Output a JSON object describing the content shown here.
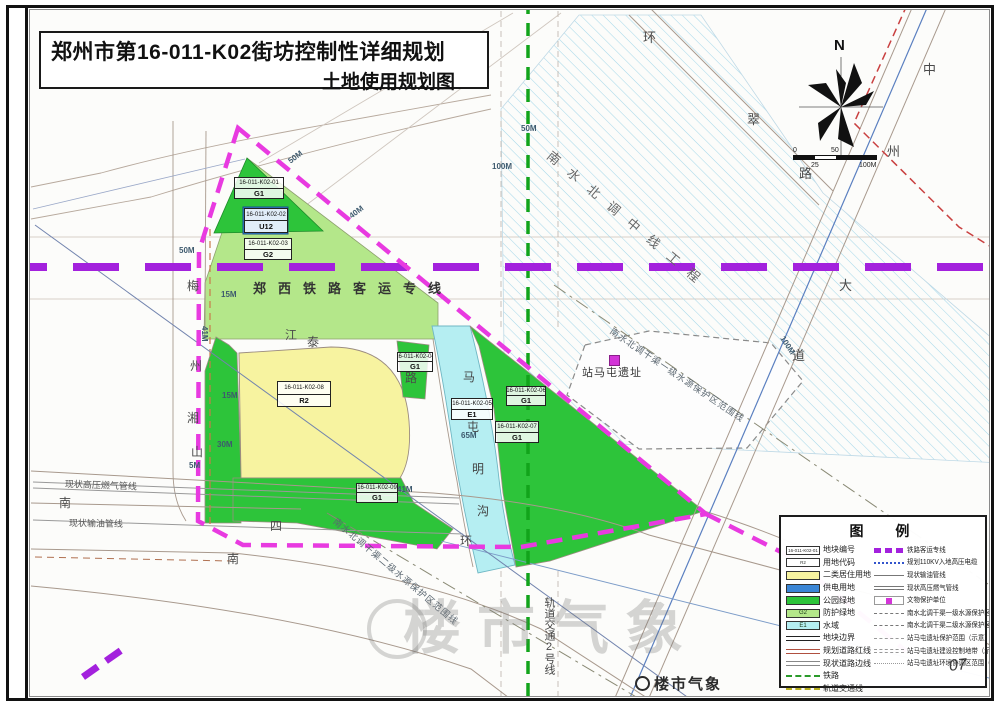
{
  "title": {
    "line1": "郑州市第16-011-K02街坊控制性详细规划",
    "line2": "土地使用规划图"
  },
  "compass": {
    "north_label": "N"
  },
  "scale_bar": {
    "labels_top": [
      "0",
      "50"
    ],
    "labels_bottom": [
      "25",
      "100M"
    ]
  },
  "colors": {
    "park_green": "#2DC43A",
    "buffer_green": "#B4E78A",
    "residential_yellow": "#F7F3A0",
    "utility_blue": "#3B86D6",
    "water_cyan": "#B5EEF2",
    "boundary_magenta": "#E83AE0",
    "railway_purple": "#A321DD",
    "metro_green": "#12A41B",
    "relic_magenta": "#D335D8"
  },
  "map": {
    "parcels": [
      {
        "code": "16-011-K02-01",
        "use": "G1",
        "x": 233,
        "y": 176,
        "w": 50,
        "h": 22
      },
      {
        "code": "16-011-K02-02",
        "use": "U12",
        "x": 243,
        "y": 207,
        "w": 44,
        "h": 25
      },
      {
        "code": "16-011-K02-03",
        "use": "G2",
        "x": 243,
        "y": 237,
        "w": 48,
        "h": 22
      },
      {
        "code": "16-011-K02-04",
        "use": "G1",
        "x": 396,
        "y": 351,
        "w": 36,
        "h": 20
      },
      {
        "code": "16-011-K02-05",
        "use": "E1",
        "x": 450,
        "y": 397,
        "w": 42,
        "h": 22
      },
      {
        "code": "16-011-K02-06",
        "use": "G1",
        "x": 505,
        "y": 385,
        "w": 40,
        "h": 20
      },
      {
        "code": "16-011-K02-07",
        "use": "G1",
        "x": 494,
        "y": 420,
        "w": 44,
        "h": 22
      },
      {
        "code": "16-011-K02-08",
        "use": "R2",
        "x": 276,
        "y": 380,
        "w": 54,
        "h": 26
      },
      {
        "code": "16-011-K02-09",
        "use": "G1",
        "x": 355,
        "y": 482,
        "w": 42,
        "h": 20
      }
    ],
    "labels": [
      {
        "text": "郑西铁路客运专线",
        "x": 252,
        "y": 281,
        "fs": 13,
        "ls": 12,
        "color": "#333333",
        "bold": true
      },
      {
        "text": "南水北调中线工程",
        "x": 552,
        "y": 148,
        "fs": 13,
        "ls": 13,
        "rot": 40,
        "color": "#666666"
      },
      {
        "text": "南水北调干渠一级水源保护区范围线",
        "x": 612,
        "y": 326,
        "fs": 9,
        "ls": 1,
        "rot": 34,
        "color": "#5a6670"
      },
      {
        "text": "南水北调干渠二级水源保护区范围线",
        "x": 336,
        "y": 516,
        "fs": 9,
        "ls": 1,
        "rot": 40,
        "color": "#5a6670"
      },
      {
        "text": "轨道交通2号线",
        "x": 542,
        "y": 596,
        "fs": 11,
        "color": "#444444",
        "vertical": true
      },
      {
        "text": "站马屯遗址",
        "x": 581,
        "y": 367,
        "fs": 11,
        "ls": 1,
        "color": "#333333"
      },
      {
        "text": "现状高压燃气管线",
        "x": 64,
        "y": 479,
        "fs": 9,
        "rot": 2,
        "color": "#555555"
      },
      {
        "text": "现状输油管线",
        "x": 68,
        "y": 518,
        "fs": 9,
        "rot": 1,
        "color": "#555555"
      },
      {
        "text": "马",
        "x": 462,
        "y": 370,
        "fs": 12,
        "color": "#444444"
      },
      {
        "text": "屯",
        "x": 466,
        "y": 420,
        "fs": 12,
        "color": "#444444"
      },
      {
        "text": "明",
        "x": 471,
        "y": 462,
        "fs": 12,
        "color": "#444444"
      },
      {
        "text": "沟",
        "x": 476,
        "y": 504,
        "fs": 12,
        "color": "#444444"
      },
      {
        "text": "环",
        "x": 642,
        "y": 30,
        "fs": 13,
        "color": "#4a4a4a"
      },
      {
        "text": "翠",
        "x": 746,
        "y": 112,
        "fs": 13,
        "color": "#4a4a4a"
      },
      {
        "text": "路",
        "x": 798,
        "y": 166,
        "fs": 13,
        "color": "#4a4a4a"
      },
      {
        "text": "中",
        "x": 922,
        "y": 62,
        "fs": 13,
        "color": "#4a4a4a"
      },
      {
        "text": "州",
        "x": 886,
        "y": 144,
        "fs": 13,
        "color": "#4a4a4a"
      },
      {
        "text": "大",
        "x": 838,
        "y": 278,
        "fs": 13,
        "color": "#4a4a4a"
      },
      {
        "text": "道",
        "x": 791,
        "y": 348,
        "fs": 13,
        "color": "#4a4a4a"
      },
      {
        "text": "江",
        "x": 284,
        "y": 328,
        "fs": 12,
        "color": "#4a4a4a"
      },
      {
        "text": "泰",
        "x": 306,
        "y": 335,
        "fs": 12,
        "color": "#4a4a4a"
      },
      {
        "text": "路",
        "x": 404,
        "y": 371,
        "fs": 12,
        "color": "#4a4a4a"
      },
      {
        "text": "梅",
        "x": 186,
        "y": 279,
        "fs": 12,
        "color": "#4a4a4a"
      },
      {
        "text": "州",
        "x": 189,
        "y": 359,
        "fs": 12,
        "color": "#4a4a4a"
      },
      {
        "text": "湘",
        "x": 186,
        "y": 411,
        "fs": 12,
        "color": "#4a4a4a"
      },
      {
        "text": "山",
        "x": 190,
        "y": 445,
        "fs": 12,
        "color": "#4a4a4a"
      },
      {
        "text": "南",
        "x": 58,
        "y": 496,
        "fs": 12,
        "color": "#4a4a4a"
      },
      {
        "text": "四",
        "x": 269,
        "y": 519,
        "fs": 12,
        "color": "#4a4a4a"
      },
      {
        "text": "环",
        "x": 459,
        "y": 534,
        "fs": 12,
        "color": "#4a4a4a"
      },
      {
        "text": "南",
        "x": 226,
        "y": 552,
        "fs": 12,
        "color": "#4a4a4a"
      }
    ],
    "dimensions": [
      {
        "text": "50M",
        "x": 178,
        "y": 246
      },
      {
        "text": "15M",
        "x": 220,
        "y": 290
      },
      {
        "text": "41M",
        "x": 207,
        "y": 325,
        "rot": 90
      },
      {
        "text": "15M",
        "x": 221,
        "y": 391
      },
      {
        "text": "30M",
        "x": 216,
        "y": 440
      },
      {
        "text": "5M",
        "x": 188,
        "y": 461
      },
      {
        "text": "50M",
        "x": 520,
        "y": 124
      },
      {
        "text": "100M",
        "x": 491,
        "y": 162
      },
      {
        "text": "65M",
        "x": 460,
        "y": 431
      },
      {
        "text": "41M",
        "x": 396,
        "y": 485
      },
      {
        "text": "50M",
        "x": 286,
        "y": 158,
        "rot": -37
      },
      {
        "text": "40M",
        "x": 347,
        "y": 213,
        "rot": -37
      },
      {
        "text": "100M",
        "x": 784,
        "y": 334,
        "rot": 57
      }
    ]
  },
  "legend": {
    "title": "图 例",
    "left": [
      {
        "label": "地块编号",
        "sw": "sw-codebox",
        "swtext": "16-011-K02-01"
      },
      {
        "label": "用地代码",
        "sw": "sw-codebox",
        "swtext": "R2"
      },
      {
        "label": "二类居住用地",
        "sw": "sw-fill",
        "color": "#F7F3A0"
      },
      {
        "label": "供电用地",
        "sw": "sw-fill",
        "color": "#3B86D6"
      },
      {
        "label": "公园绿地",
        "sw": "sw-fill",
        "color": "#2DC43A"
      },
      {
        "label": "防护绿地",
        "sw": "sw-fill",
        "color": "#B4E78A",
        "swtext": "G2"
      },
      {
        "label": "水域",
        "sw": "sw-fill",
        "color": "#B5EEF2",
        "swtext": "E1"
      },
      {
        "label": "地块边界",
        "sw": "sw-line2black"
      },
      {
        "label": "规划道路红线",
        "sw": "sw-line2red"
      },
      {
        "label": "现状道路边线",
        "sw": "sw-line2grey"
      },
      {
        "label": "铁路",
        "sw": "sw-greendash"
      },
      {
        "label": "轨道交通线",
        "sw": "sw-yellowdash"
      }
    ],
    "right": [
      {
        "label": "铁路客运专线",
        "sw": "sw-purpledash"
      },
      {
        "label": "规划110KV入地高压电缆",
        "sw": "sw-bluedot"
      },
      {
        "label": "现状输油管线",
        "sw": "sw-greyline"
      },
      {
        "label": "现状高压燃气管线",
        "sw": "sw-greydouble"
      },
      {
        "label": "文物保护单位",
        "sw": "sw-magsq"
      },
      {
        "label": "南水北调干渠一级水源保护区范围线",
        "sw": "sw-dashdot"
      },
      {
        "label": "南水北调干渠二级水源保护区范围线",
        "sw": "sw-dashdot"
      },
      {
        "label": "站马屯遗址保护范围（示意）",
        "sw": "sw-dasha"
      },
      {
        "label": "站马屯遗址建设控制地带（示意）",
        "sw": "sw-dashb"
      },
      {
        "label": "站马屯遗址环境协调区范围（示意）",
        "sw": "sw-dashc"
      }
    ]
  },
  "watermark": {
    "big": "楼市气象",
    "small": "楼市气象",
    "page": "07"
  }
}
